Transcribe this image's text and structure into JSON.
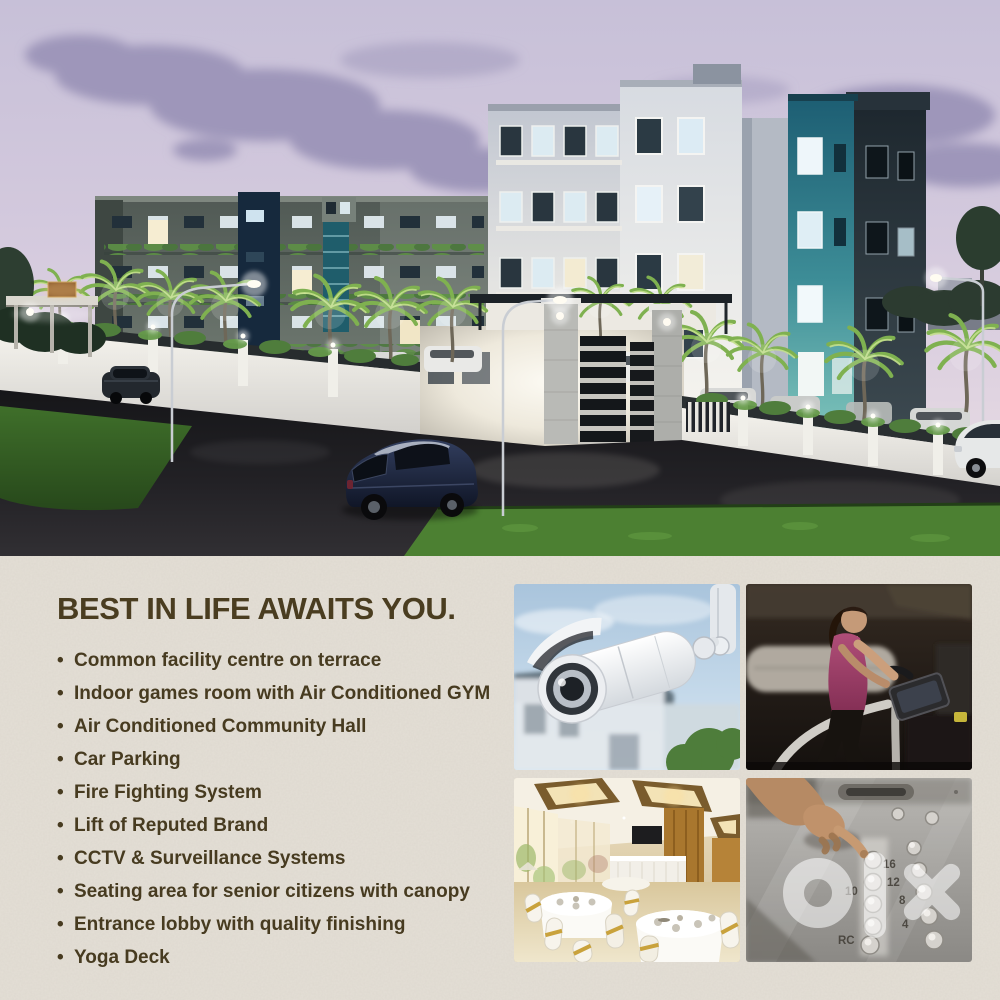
{
  "page": {
    "background_color": "#e4dfd6",
    "accent_teal": "#2e7d8c",
    "text_color": "#4a3d20"
  },
  "headline": {
    "text": "BEST IN LIFE AWAITS YOU."
  },
  "amenities": [
    "Common facility centre on terrace",
    "Indoor games room with Air Conditioned GYM",
    "Air Conditioned Community Hall",
    "Car Parking",
    "Fire Fighting System",
    "Lift of Reputed Brand",
    "CCTV & Surveillance Systems",
    "Seating area for senior citizens with canopy",
    "Entrance lobby with quality finishing",
    "Yoga Deck"
  ],
  "photos": {
    "hero": {
      "label": "apartment-complex-night-rendering"
    },
    "cctv": {
      "label": "cctv-security-camera"
    },
    "gym": {
      "label": "woman-on-elliptical-in-gym"
    },
    "hall": {
      "label": "banquet-community-hall"
    },
    "lift": {
      "label": "elevator-button-panel",
      "floor_labels": [
        "16",
        "12",
        "10",
        "8",
        "4",
        "RC"
      ]
    }
  },
  "watermark": {
    "text": "olx",
    "color": "#ffffff"
  }
}
